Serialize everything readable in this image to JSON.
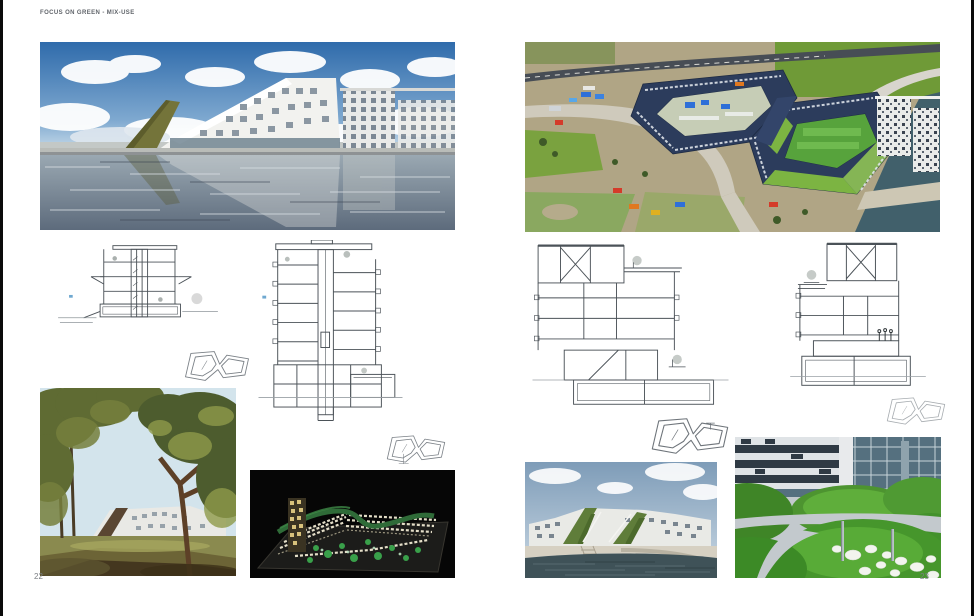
{
  "header": {
    "title": "FOCUS ON GREEN - MIX-USE"
  },
  "footer": {
    "page_left": "22",
    "page_right": "23"
  },
  "colors": {
    "paper": "#ffffff",
    "text_muted": "#60646a",
    "edge_black": "#0a0a0a",
    "sky_blue": "#3f7ab8",
    "sky_pale": "#a9c8e0",
    "water_gray": "#8b99a6",
    "roof_olive": "#74743a",
    "navy_roof": "#2e3f5e",
    "grass_green": "#4f9430",
    "courtyard_green": "#57a33c",
    "drawing_line": "#4b5258",
    "night_black": "#060606",
    "sea_teal": "#41606b",
    "quay_beige": "#d6d0c2"
  }
}
